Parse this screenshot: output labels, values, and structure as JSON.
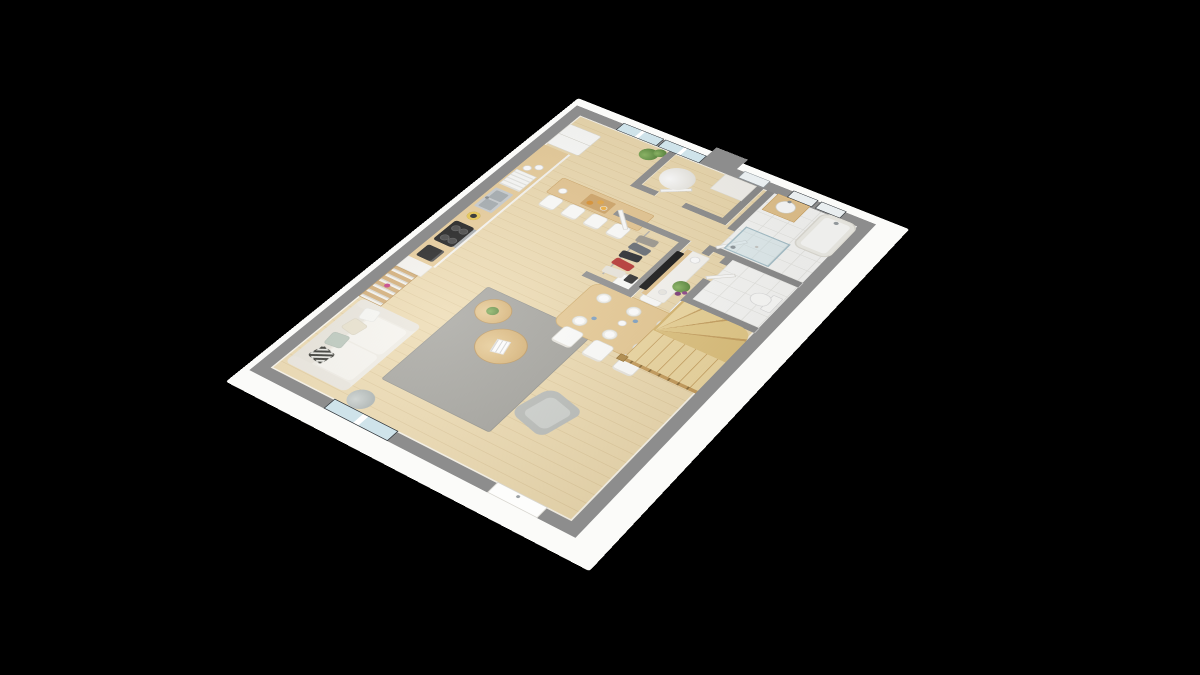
{
  "scene": {
    "title": "3D isometric floor plan render of a single-storey open-plan home",
    "background": "#000000",
    "projection": "isometric dollhouse view, plan rotated as a diamond on black"
  },
  "colors": {
    "wall": "#8d8d8d",
    "wallface": "#fbfbf9",
    "wood": "#ecd9ae",
    "counter": "#e7cb97",
    "shelfwood": "#d1aa72",
    "rug": "#a3a29c",
    "tile": "#f8f8f6",
    "glass": "#cfe3ea",
    "frame": "#363b40",
    "tv": "#141414",
    "red_garment": "#b5312e",
    "plant_green": "#5c8a3e",
    "flower_purple": "#7c3a78",
    "stair_wood": "#ecd69e"
  },
  "rooms": {
    "living": {
      "label": "Living room",
      "furniture": [
        "white sofa with pillows",
        "floor lamp",
        "gray rug",
        "two round coffee tables",
        "gray armchair",
        "TV on stand"
      ]
    },
    "kitchen": {
      "label": "Kitchen",
      "furniture": [
        "counter run",
        "coffee machine",
        "cooktop with oven",
        "blender",
        "double sink",
        "dish rack with plates and cups",
        "fridge",
        "tall cabinet",
        "bookshelf"
      ]
    },
    "dining": {
      "label": "Dining area",
      "furniture": [
        "wood dining table",
        "6 white chairs",
        "6 place settings"
      ]
    },
    "bar": {
      "label": "Breakfast bar",
      "furniture": [
        "wood bar table",
        "4 white stools",
        "breakfast tray",
        "cup"
      ]
    },
    "closet": {
      "label": "Closet",
      "furniture": [
        "clothes rail",
        "5 hanging garments",
        "bag"
      ]
    },
    "hall": {
      "label": "Hallway",
      "furniture": [
        "open white doors",
        "potted plant with purple flowers"
      ]
    },
    "utility": {
      "label": "Utility room",
      "furniture": [
        "cylindrical water heater",
        "white cabinet"
      ]
    },
    "bathroom": {
      "label": "Bathroom",
      "furniture": [
        "glass shower",
        "bathtub",
        "wood vanity with basin",
        "two high windows"
      ]
    },
    "wc": {
      "label": "WC",
      "furniture": [
        "toilet"
      ]
    },
    "stairs": {
      "label": "Winding wooden staircase",
      "furniture": [
        "railing with balusters",
        "newel post"
      ]
    }
  },
  "openings": {
    "northeast_wall": [
      "french glass door 1",
      "french glass door 2",
      "utility window",
      "bathroom window 1",
      "bathroom window 2"
    ],
    "southwest_wall": [
      "sliding glass door",
      "entry door"
    ]
  },
  "items": {
    "sofa": "White three-seat sofa with striped, sage and cream pillows",
    "lamp": "Tripod floor lamp with gray shade",
    "rug": "Gray area rug",
    "coffee_table_large": "Round wood coffee table with magazine",
    "coffee_table_small": "Round wood side table with plant",
    "armchair": "Gray armchair",
    "bookshelf": "Tall wood bookshelf with white books",
    "counter": "Kitchen counter, wood top with white fronts",
    "coffee_machine": "Black espresso machine",
    "cooktop": "Black 4-burner cooktop",
    "oven": "Stainless oven front",
    "blender": "Blender with yellow jar",
    "sink": "Stainless double sink",
    "dish_rack": "Dish rack with plates",
    "cups": "White cups on counter",
    "fridge": "White two-door fridge",
    "bar": "Breakfast bar",
    "tray": "Breakfast tray with croissants and juice",
    "dining_table": "Oval wood dining table set for six",
    "tv": "Flat-screen TV",
    "tv_stand": "White TV stand with wood top and vase",
    "clothes": "Hanging clothes in open closet",
    "water_heater": "Cylindrical water heater",
    "shower": "Glass shower enclosure",
    "bathtub": "Built-in bathtub",
    "vanity": "Wood vanity with round basin",
    "toilet": "Toilet",
    "stairs": "Quarter-turn winding wooden staircase",
    "plant_big": "Green potted plant by glass doors",
    "plant_small": "Plant with purple flowers in hallway",
    "entry_door": "White entry door",
    "sliding_door": "Sliding glass door",
    "french_doors": "Dark-framed glazed french doors"
  }
}
